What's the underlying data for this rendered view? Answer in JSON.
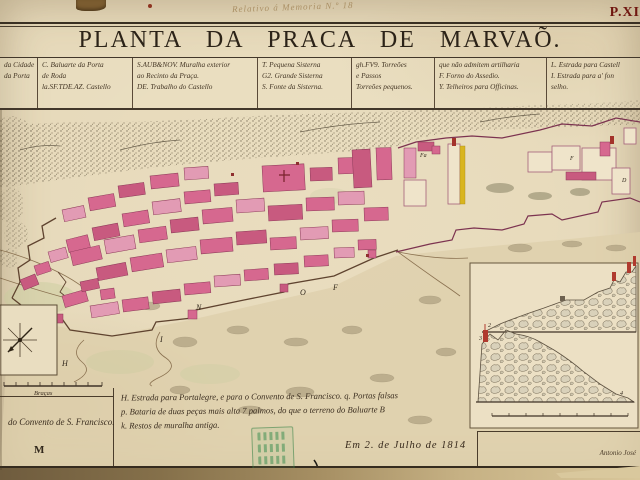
{
  "header": {
    "handwritten_note": "Relativo á Memoria N.º 18",
    "plate_number": "P.XI"
  },
  "title": "PLANTA DA PRACA DE MARVAÕ.",
  "legend": {
    "columns": [
      {
        "lines": [
          "da Cidade",
          "da Porta",
          ""
        ]
      },
      {
        "lines": [
          "C. Baluarte da Porta",
          "de Roda",
          "la.SF.TDE.AZ. Castello"
        ]
      },
      {
        "lines": [
          "S.AUB&NOV. Muralha exterior",
          "ao Recinto da Praça.",
          "DE. Trabalho do Castello"
        ]
      },
      {
        "lines": [
          "T. Pequena Sisterna",
          "G2. Grande Sisterna",
          "S. Fonte da Sisterna."
        ]
      },
      {
        "lines": [
          "gh.FV9. Torreões",
          "e Passos",
          "Torreões pequenos."
        ]
      },
      {
        "lines": [
          "que não admitem artilharia",
          "F. Forno do Assedio.",
          "Y. Telheiros para Officinas."
        ]
      },
      {
        "lines": [
          "L. Estrada para Castell",
          "I. Estrada para a' fon",
          "selho."
        ]
      }
    ]
  },
  "map_labels": {
    "h": "H",
    "n": "N",
    "o": "O",
    "f_wall": "F",
    "i": "I",
    "m": "M",
    "fa": "Fa",
    "f_castle": "F",
    "d": "D",
    "scale_label": "Braças",
    "profile_upper": "2",
    "profile_lower_left": "3",
    "profile_lower_right": "4"
  },
  "notes": {
    "line1": "H. Estrada para Portalegre, e para o Convento de S. Francisco. q. Portas falsas",
    "line2": "p. Bataria de duas peças mais alta 7 palmos, do que o terreno do Baluarte B",
    "line3": "k. Restos de muralha antiga."
  },
  "bottom_left": {
    "caption": "do Convento de S. Francisco.",
    "letter": "M"
  },
  "date_line": "Em 2. de Julho de 1814",
  "signature": "Antonio José",
  "colors": {
    "building_pink": "#d6688f",
    "wall_red": "#7c3350",
    "accent_yellow": "#d9b51f",
    "stamp_green": "#3f8f52",
    "plate_red": "#701710"
  }
}
